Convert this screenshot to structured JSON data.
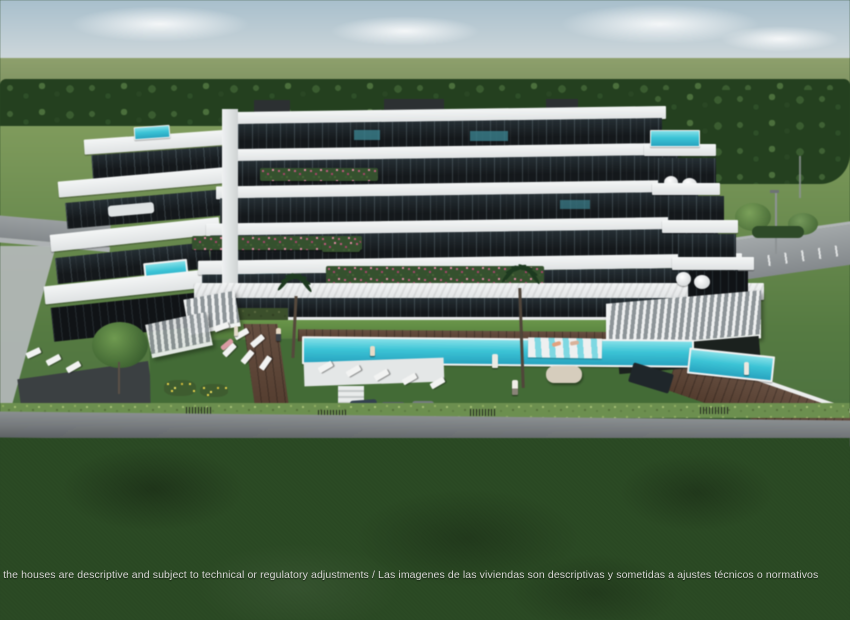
{
  "scene": {
    "disclaimer": "f the houses are descriptive and subject to technical or regulatory adjustments / Las imagenes de las viviendas son descriptivas y sometidas a ajustes técnicos o normativos"
  },
  "colors": {
    "sky_top": "#a8bfcc",
    "sky_horizon": "#dadfe0",
    "distant_field": "#7d9161",
    "tree_dark": "#24401f",
    "mid_grass": "#7f9b5c",
    "resort_lawn": "#436b36",
    "foreground_lawn": "#2b4a24",
    "pool_water": "#3cc4d6",
    "building_white": "#eef0f0",
    "building_glass": "#14181b",
    "deck_brown": "#5a4132",
    "road_gray": "#84898c",
    "wall_gray": "#75797c",
    "hedge_green": "#6c8f4f",
    "flower_pink": "#c05a7e",
    "text_color": "#d9d9d6"
  }
}
